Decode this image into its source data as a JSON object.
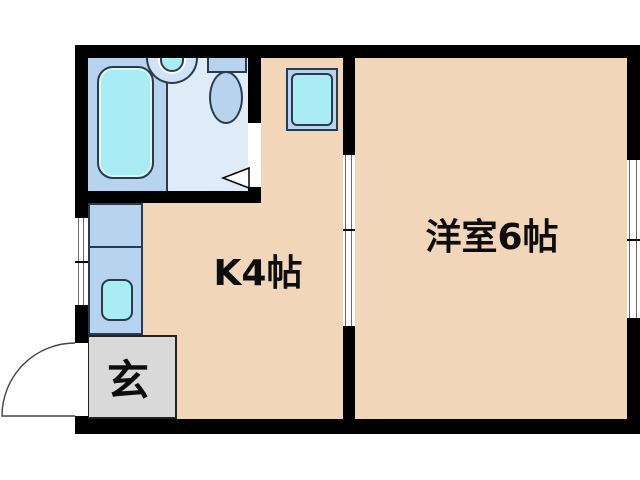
{
  "title": "apartment-floor-plan",
  "rooms": {
    "kitchen": {
      "label": "K4帖"
    },
    "western_room": {
      "label": "洋室6帖"
    },
    "entrance": {
      "label": "玄"
    }
  },
  "fixtures": {
    "bathtub": "bathtub",
    "wash_basin": "wash-basin",
    "toilet": "toilet",
    "washing_machine": "washing-machine-space",
    "kitchen_counter": "kitchen-counter",
    "kitchen_sink": "kitchen-sink",
    "entrance_step": "entrance-step"
  },
  "colors": {
    "wall": "#000000",
    "floor": "#f2d6ba",
    "bath_floor": "#b7d3ee",
    "toilet_floor": "#e0ebf8",
    "fixture_blue": "#b7d3ee",
    "water_cyan": "#a9ecf4",
    "entry_gray": "#d9d9d9",
    "outline": "#2b3b4e"
  }
}
